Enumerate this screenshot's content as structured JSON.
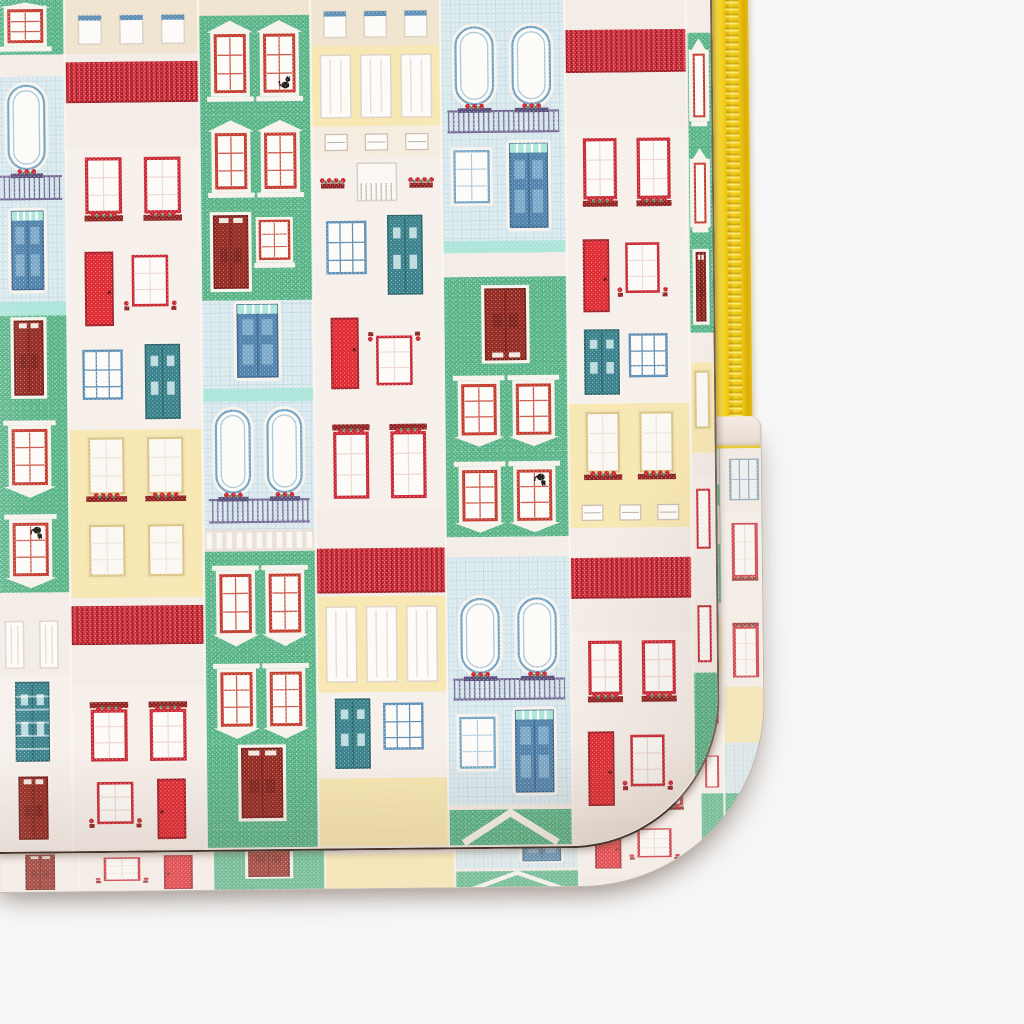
{
  "scene": {
    "type": "product-photo",
    "background": "#f7f7f7",
    "subject": "Fabric laptop sleeve with a Portuguese row-house print, yellow zipper along the right edge, rounded stitched bottom-right corner, photographed on a plain light grey background"
  },
  "sleeve": {
    "fabric": "woven canvas, house-facade print",
    "zipper_color_name": "yellow",
    "front_width_px": 712,
    "front_height_px": 854,
    "corner_radius_px": 150,
    "gusset_right_edge_px": 756,
    "gusset_bottom_px": 890,
    "zipper_x_px": 712,
    "zipper_width_px": 36,
    "zipper_visible_length_px": 434,
    "tilt_deg": -0.6
  },
  "palette": {
    "background": "#f7f7f7",
    "fabric_base": "#f4ece6",
    "fabric_white": "#f3ebe5",
    "fabric_pink": "#f6efe9",
    "cream": "#efe3cd",
    "mint": "#a9e4d8",
    "green": "#53b183",
    "green_light": "#7fcba4",
    "red": "#c92531",
    "red_dark": "#a01b26",
    "red_bright": "#e02830",
    "brick_door": "#93261e",
    "yellow_wall": "#f7e6ae",
    "yellow_trim": "#d9c17e",
    "azulejo": "#dcebf0",
    "azulejo_line": "#c3dae2",
    "blue_door": "#4d80aa",
    "blue_panel": "#7ba7c8",
    "blue_frame": "#6fa3c4",
    "teal_door": "#36808a",
    "steel_grid": "#5b8db4",
    "lavender": "#6f628f",
    "rail_dark": "#574b78",
    "window_white": "#fdfbf8",
    "trim_white": "#f6f2ec",
    "flower_box": "#8e1f1f",
    "leaf": "#4d8f5f",
    "cat": "#1c1916",
    "zipper_yellow": "#f6d41f",
    "seam": "#46352d",
    "gusset_base": "#f1e8e2",
    "stitch_yellow": "#e6ca3a"
  },
  "pattern": {
    "motif": "Portuguese/Aveiro striped row houses: green brick facades with white pediment windows and red sashes, white houses with red tiled roofs and red-framed windows with flower boxes, azulejo blue-tiled houses with arched windows and wrought-iron balconies, yellow houses with lace windows, red / dark-red / steel-blue / teal doors, potted red flowers, black cat in a window; rows alternate upright and upside-down",
    "front_columns": [
      {
        "x": -14,
        "w": 78,
        "segs": [
          {
            "t": "pediment",
            "h": 55,
            "n": 1
          },
          {
            "t": "band",
            "c": "white",
            "h": 22
          },
          {
            "t": "arch",
            "h": 130,
            "n": 1
          },
          {
            "t": "doorBlue",
            "h": 95
          },
          {
            "t": "band",
            "c": "mint",
            "h": 14
          },
          {
            "t": "doorDark",
            "h": 92,
            "bg": "green"
          },
          {
            "t": "pediment",
            "h": 95,
            "n": 1,
            "flip": 1
          },
          {
            "t": "pediment",
            "h": 90,
            "n": 1,
            "flip": 1,
            "cat": 1
          },
          {
            "t": "band",
            "c": "white",
            "h": 22
          },
          {
            "t": "lace",
            "h": 60,
            "n": 2,
            "bg": "white"
          },
          {
            "t": "doorTeal",
            "h": 98,
            "striped": 1,
            "noWin": 1
          },
          {
            "t": "doorDark",
            "h": 77,
            "bg": "white"
          }
        ]
      },
      {
        "x": 64,
        "w": 134,
        "segs": [
          {
            "t": "attic",
            "h": 55
          },
          {
            "t": "roof",
            "h": 52
          },
          {
            "t": "band",
            "c": "white",
            "h": 42
          },
          {
            "t": "win2",
            "h": 92
          },
          {
            "t": "doorRed",
            "h": 98
          },
          {
            "t": "doorTeal",
            "h": 92
          },
          {
            "t": "winY",
            "h": 88
          },
          {
            "t": "winY",
            "h": 80,
            "plain": 1
          },
          {
            "t": "roof",
            "h": 50
          },
          {
            "t": "band",
            "c": "white",
            "h": 38
          },
          {
            "t": "win2",
            "h": 84,
            "flip": 1
          },
          {
            "t": "doorRed",
            "h": 79,
            "mirror": 1
          }
        ]
      },
      {
        "x": 198,
        "w": 112,
        "segs": [
          {
            "t": "band",
            "c": "cream",
            "h": 18
          },
          {
            "t": "pediment",
            "h": 100,
            "cat": 1
          },
          {
            "t": "pediment",
            "h": 95
          },
          {
            "t": "doorDark",
            "h": 90,
            "bg": "green",
            "sideWin": 1
          },
          {
            "t": "doorBlue",
            "h": 88
          },
          {
            "t": "band",
            "c": "mint",
            "h": 13
          },
          {
            "t": "arch",
            "h": 128,
            "n": 2
          },
          {
            "t": "band",
            "c": "picket",
            "h": 22
          },
          {
            "t": "pediment",
            "h": 100,
            "flip": 1
          },
          {
            "t": "pediment",
            "h": 92,
            "flip": 1
          },
          {
            "t": "doorDark",
            "h": 86,
            "bg": "green"
          },
          {
            "t": "band",
            "c": "green",
            "h": 18
          }
        ]
      },
      {
        "x": 310,
        "w": 130,
        "segs": [
          {
            "t": "attic",
            "h": 50
          },
          {
            "t": "lace",
            "h": 80,
            "bg": "yellow"
          },
          {
            "t": "win3",
            "h": 32
          },
          {
            "t": "balconyF",
            "h": 50
          },
          {
            "t": "doorTeal",
            "h": 98
          },
          {
            "t": "doorRed",
            "h": 94,
            "flip": 1
          },
          {
            "t": "win2",
            "h": 110,
            "flip": 1
          },
          {
            "t": "band",
            "c": "white",
            "h": 30
          },
          {
            "t": "roof",
            "h": 56
          },
          {
            "t": "lace",
            "h": 96,
            "bg": "yellow"
          },
          {
            "t": "doorTeal",
            "h": 86,
            "mirror": 1
          },
          {
            "t": "band",
            "c": "yellow",
            "h": 68
          }
        ]
      },
      {
        "x": 440,
        "w": 124,
        "segs": [
          {
            "t": "band",
            "c": "azulejo",
            "h": 24
          },
          {
            "t": "arch",
            "h": 120,
            "n": 2
          },
          {
            "t": "doorBlue",
            "h": 102,
            "sideWin": 1
          },
          {
            "t": "band",
            "c": "mint",
            "h": 12
          },
          {
            "t": "band",
            "c": "white",
            "h": 24
          },
          {
            "t": "doorDark",
            "h": 88,
            "bg": "green",
            "flip": 1
          },
          {
            "t": "pediment",
            "h": 86,
            "flip": 1
          },
          {
            "t": "pediment",
            "h": 86,
            "flip": 1,
            "cat": 1
          },
          {
            "t": "band",
            "c": "white",
            "h": 20
          },
          {
            "t": "band",
            "c": "azulejo",
            "h": 34
          },
          {
            "t": "arch",
            "h": 115,
            "n": 2
          },
          {
            "t": "doorBlue",
            "h": 99,
            "sideWin": 1
          },
          {
            "t": "gable",
            "h": 40
          }
        ]
      },
      {
        "x": 564,
        "w": 122,
        "segs": [
          {
            "t": "band",
            "c": "white",
            "h": 28
          },
          {
            "t": "roof",
            "h": 54
          },
          {
            "t": "band",
            "c": "white",
            "h": 52
          },
          {
            "t": "win2",
            "h": 100
          },
          {
            "t": "doorRed",
            "h": 96
          },
          {
            "t": "doorTeal",
            "h": 80,
            "mirror": 1
          },
          {
            "t": "winY",
            "h": 94
          },
          {
            "t": "win3",
            "h": 30,
            "bg": "yellow"
          },
          {
            "t": "band",
            "c": "white",
            "h": 22
          },
          {
            "t": "roof",
            "h": 52
          },
          {
            "t": "band",
            "c": "white",
            "h": 30
          },
          {
            "t": "win2",
            "h": 88
          },
          {
            "t": "doorRed",
            "h": 98
          },
          {
            "t": "band",
            "c": "white",
            "h": 26
          }
        ]
      },
      {
        "x": 686,
        "w": 24,
        "segs": [
          {
            "t": "band",
            "c": "white",
            "h": 40
          },
          {
            "t": "pediment",
            "h": 110,
            "n": 1
          },
          {
            "t": "pediment",
            "h": 105,
            "n": 1
          },
          {
            "t": "doorDark",
            "h": 85,
            "bg": "green"
          },
          {
            "t": "band",
            "c": "white",
            "h": 30
          },
          {
            "t": "winY",
            "h": 90,
            "n": 1
          },
          {
            "t": "band",
            "c": "white",
            "h": 25
          },
          {
            "t": "win2",
            "h": 100,
            "n": 1
          },
          {
            "t": "win2",
            "h": 95,
            "n": 1,
            "flip": 1
          },
          {
            "t": "band",
            "c": "green",
            "h": 170
          }
        ]
      }
    ],
    "gusset_extra_column": {
      "x": 710,
      "w": 46,
      "segs": [
        {
          "t": "band",
          "c": "white",
          "h": 60
        },
        {
          "t": "winGrid",
          "h": 120
        },
        {
          "t": "win2",
          "h": 160,
          "n": 1
        },
        {
          "t": "win2",
          "h": 150,
          "n": 1,
          "flip": 1
        },
        {
          "t": "band",
          "c": "yellow",
          "h": 100
        },
        {
          "t": "band",
          "c": "azulejo",
          "h": 90
        },
        {
          "t": "band",
          "c": "green",
          "h": 160
        }
      ]
    },
    "gusset_squash": {
      "translate_x": 26,
      "translate_y": -4,
      "scale_y": 0.56
    }
  }
}
